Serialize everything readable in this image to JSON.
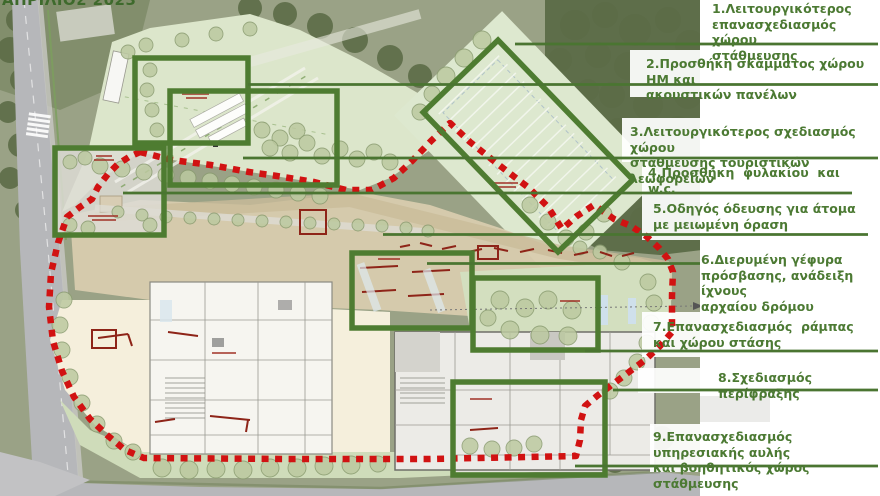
{
  "title": "ΑΠΡΙΛΙΟΣ 2023",
  "drawing": {
    "type": "architectural-site-plan",
    "highlight_color": "#4e7c31",
    "boundary_color": "#d11212",
    "label_color": "#4c7a33"
  },
  "callouts": [
    {
      "id": 1,
      "lines": [
        "1.Λειτουργικότερος",
        "επανασχεδιασμός χώρου",
        "στάθμευσης"
      ]
    },
    {
      "id": 2,
      "lines": [
        "2.Προσθήκη σκάμματος χώρου ΗΜ και",
        "ακουστικών πανέλων"
      ]
    },
    {
      "id": 3,
      "lines": [
        "3.Λειτουργικότερος σχεδιασμός χώρου",
        "στάθμευσης τουριστικών λεωφορείων"
      ]
    },
    {
      "id": 4,
      "lines": [
        "4.Προσθήκη  φυλακίου  και",
        "w.c."
      ]
    },
    {
      "id": 5,
      "lines": [
        "5.Οδηγός όδευσης για άτομα",
        "με μειωμένη όραση"
      ]
    },
    {
      "id": 6,
      "lines": [
        "6.Διερυμένη γέφυρα",
        "πρόσβασης, ανάδειξη ίχνους",
        "αρχαίου δρόμου"
      ]
    },
    {
      "id": 7,
      "lines": [
        "7.Επανασχεδιασμός  ράμπας",
        "και χώρου στάσης"
      ]
    },
    {
      "id": 8,
      "lines": [
        "8.Σχεδιασμός περίφραξης"
      ]
    },
    {
      "id": 9,
      "lines": [
        "9.Επανασχεδιασμός υπηρεσιακής αυλής",
        "και βοηθητικός χώρος στάθμευσης"
      ]
    }
  ]
}
